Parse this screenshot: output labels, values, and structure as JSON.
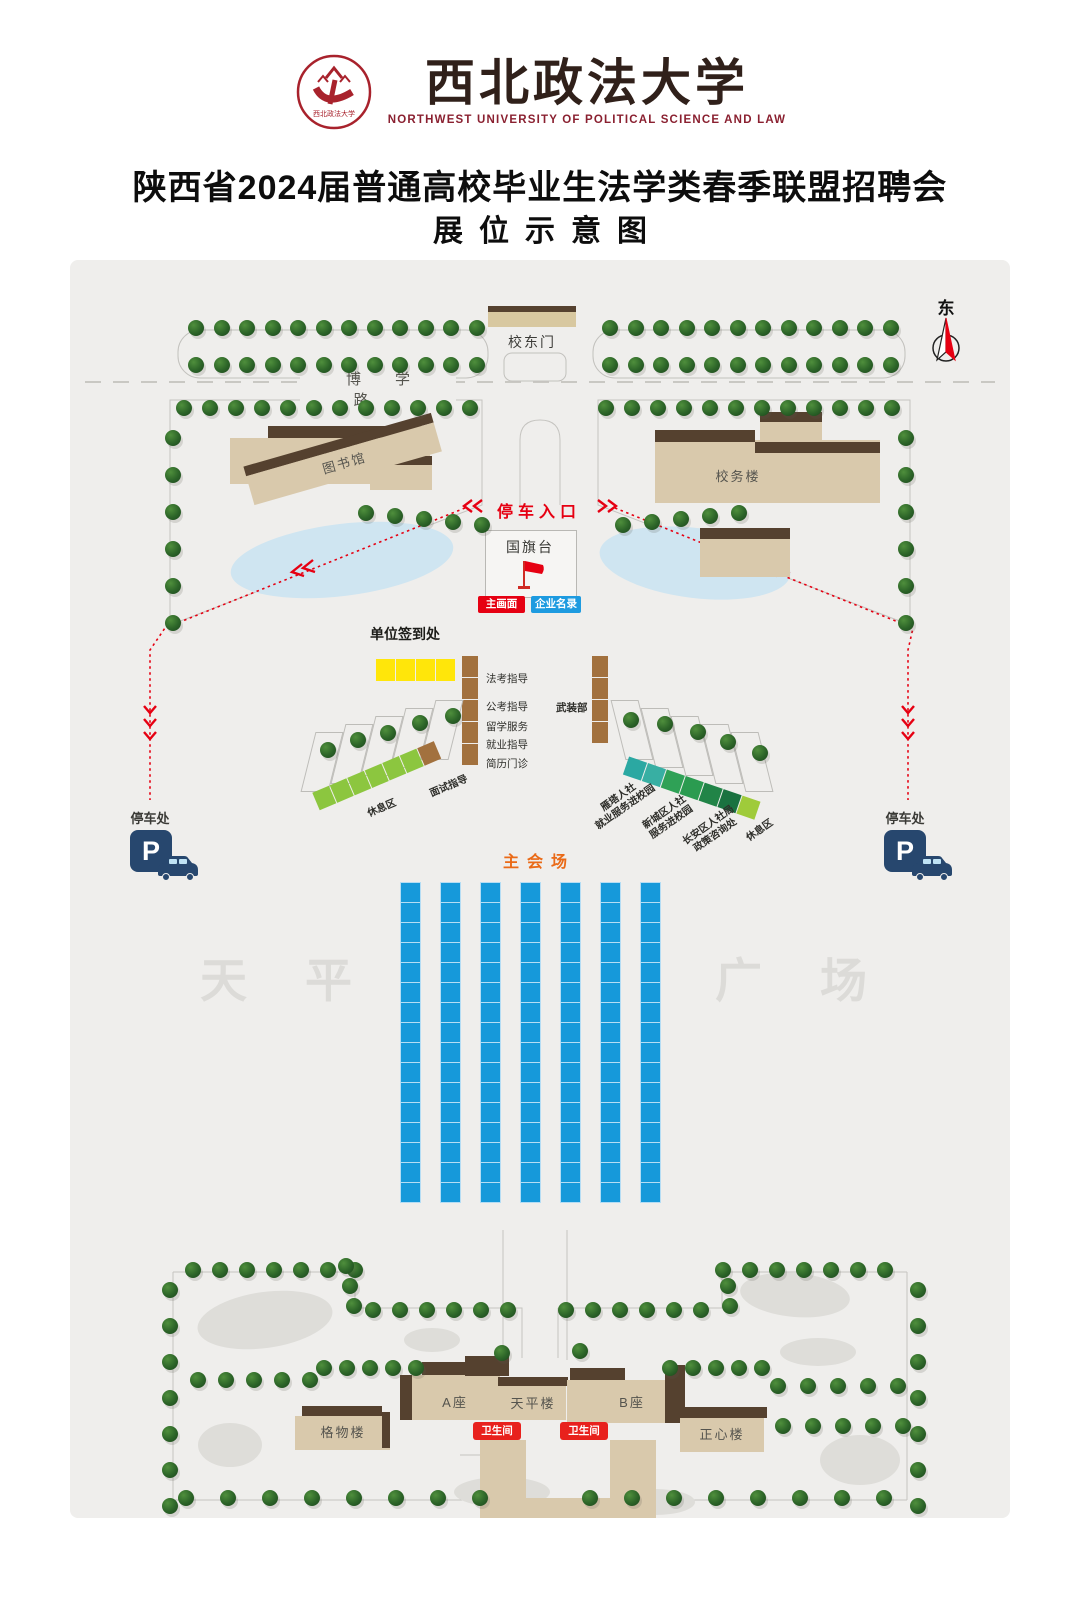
{
  "header": {
    "university_name": "西北政法大学",
    "university_name_en": "NORTHWEST UNIVERSITY OF POLITICAL SCIENCE AND LAW",
    "title": "陕西省2024届普通高校毕业生法学类春季联盟招聘会",
    "subtitle": "展位示意图"
  },
  "map": {
    "compass_label": "东",
    "road_label": "博学路",
    "gate_label": "校东门",
    "parking_entrance_label": "停车入口",
    "flag_platform_label": "国旗台",
    "main_screen_label": "主画面",
    "company_directory_label": "企业名录",
    "checkin_label": "单位签到处",
    "service_booths": [
      "法考指导",
      "公考指导",
      "留学服务",
      "就业指导",
      "简历门诊"
    ],
    "armed_forces_label": "武装部",
    "interview_label": "面试指导",
    "rest_area_label": "休息区",
    "hr_booth_labels": [
      {
        "line1": "雁塔人社",
        "line2": "就业服务进校园"
      },
      {
        "line1": "新城区人社",
        "line2": "服务进校园"
      },
      {
        "line1": "长安区人社局",
        "line2": "政策咨询处"
      },
      {
        "line1": "休息区",
        "line2": ""
      }
    ],
    "main_venue_label": "主会场",
    "parking_label": "停车处",
    "parking_symbol": "P",
    "watermark_left": "天平",
    "watermark_right": "广场",
    "buildings": {
      "library_upper": "图书馆",
      "library_lower": "图书馆",
      "admin_building": "校务楼",
      "gewu_building": "格物楼",
      "block_a": "A座",
      "tianping_building": "天平楼",
      "block_b": "B座",
      "zhengxin_building": "正心楼"
    },
    "restroom_label": "卫生间",
    "booth_grid": {
      "columns": 7,
      "rows_per_column": 16
    },
    "rest_row_cells": [
      "#8CC63F",
      "#8CC63F",
      "#8CC63F",
      "#8CC63F",
      "#8CC63F",
      "#8CC63F",
      "#A2713E"
    ],
    "hr_row_cells": [
      "#2BA8A2",
      "#38AFA3",
      "#2FA156",
      "#2B9B50",
      "#218447",
      "#1A7240",
      "#9FCB3A"
    ],
    "colors": {
      "booth_blue": "#1699DA",
      "signin_yellow": "#FFE60A",
      "guide_brown": "#A2713E",
      "rest_green": "#8CC63F",
      "accent_red": "#E60012",
      "directory_blue": "#1E9BE0",
      "venue_orange": "#EA6A17",
      "parking_navy": "#27476E",
      "pond_blue": "#CFE5F1"
    }
  }
}
